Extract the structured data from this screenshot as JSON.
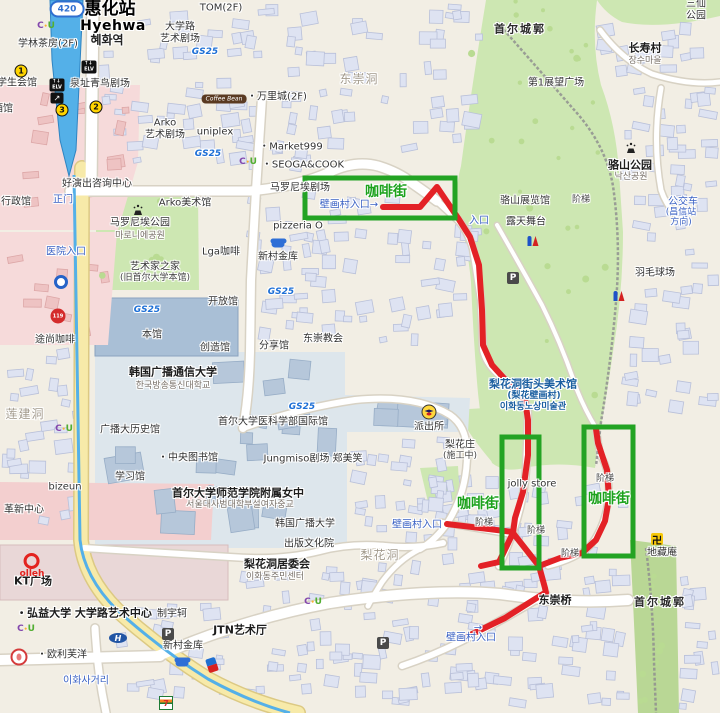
{
  "palette": {
    "route_red": "#e32126",
    "box_green": "#23a323",
    "coffee_green": "#1ca21c",
    "park_green": "#cde7b2",
    "water_blue": "#54b0e8",
    "road_yellow": "#f7eaa9"
  },
  "annotations": {
    "boxes": [
      {
        "x": 305,
        "y": 178,
        "w": 150,
        "h": 40
      },
      {
        "x": 502,
        "y": 437,
        "w": 37,
        "h": 131
      },
      {
        "x": 584,
        "y": 427,
        "w": 49,
        "h": 129
      }
    ],
    "routes": [
      [
        [
          383,
          207
        ],
        [
          420,
          207
        ],
        [
          437,
          187
        ],
        [
          458,
          218
        ],
        [
          470,
          237
        ],
        [
          479,
          265
        ],
        [
          482,
          310
        ],
        [
          483,
          345
        ],
        [
          492,
          365
        ],
        [
          512,
          387
        ],
        [
          525,
          400
        ],
        [
          528,
          420
        ],
        [
          528,
          455
        ],
        [
          523,
          492
        ],
        [
          515,
          518
        ],
        [
          513,
          533
        ]
      ],
      [
        [
          447,
          524
        ],
        [
          513,
          532
        ]
      ],
      [
        [
          513,
          533
        ],
        [
          499,
          562
        ],
        [
          481,
          566
        ]
      ],
      [
        [
          513,
          533
        ],
        [
          539,
          566
        ],
        [
          545,
          588
        ],
        [
          546,
          593
        ]
      ],
      [
        [
          543,
          594
        ],
        [
          505,
          618
        ],
        [
          462,
          639
        ]
      ],
      [
        [
          539,
          566
        ],
        [
          560,
          558
        ],
        [
          582,
          553
        ],
        [
          596,
          540
        ],
        [
          605,
          521
        ],
        [
          609,
          498
        ],
        [
          607,
          470
        ],
        [
          598,
          443
        ],
        [
          596,
          429
        ]
      ]
    ]
  },
  "labels": [
    {
      "t": "惠化站",
      "x": 110,
      "y": 10,
      "c": "st1"
    },
    {
      "t": "Hyehwa",
      "x": 113,
      "y": 26,
      "c": "st2"
    },
    {
      "t": "혜화역",
      "x": 107,
      "y": 41,
      "c": "st3"
    },
    {
      "t": "TOM(2F)",
      "x": 221,
      "y": 8,
      "c": "poi"
    },
    {
      "t": "学林茶房(2F)",
      "x": 48,
      "y": 44,
      "c": "poi"
    },
    {
      "t": "大学路\n艺术剧场",
      "x": 180,
      "y": 33,
      "c": "poi"
    },
    {
      "t": "学生会馆",
      "x": 17,
      "y": 83,
      "c": "poi"
    },
    {
      "t": "泉址青鸟剧场",
      "x": 100,
      "y": 84,
      "c": "poi"
    },
    {
      "t": "酒馆",
      "x": 3,
      "y": 109,
      "c": "poi"
    },
    {
      "t": "Arko\n艺术剧场",
      "x": 165,
      "y": 129,
      "c": "poi"
    },
    {
      "t": "uniplex",
      "x": 215,
      "y": 132,
      "c": "poi"
    },
    {
      "t": "・万里城(2F)",
      "x": 277,
      "y": 97,
      "c": "poi"
    },
    {
      "t": "东崇洞",
      "x": 359,
      "y": 80,
      "c": "area"
    },
    {
      "t": "・Market999",
      "x": 291,
      "y": 147,
      "c": "poi"
    },
    {
      "t": "・SEOGA&COOK",
      "x": 303,
      "y": 165,
      "c": "poi"
    },
    {
      "t": "三仙公园",
      "x": 696,
      "y": 10,
      "c": "poi"
    },
    {
      "t": "首尔城郭",
      "x": 520,
      "y": 30,
      "c": "wall"
    },
    {
      "t": "长寿村",
      "x": 645,
      "y": 49,
      "c": "lg"
    },
    {
      "t": "장수마을",
      "x": 645,
      "y": 61,
      "c": "kr"
    },
    {
      "t": "第1展望广场",
      "x": 556,
      "y": 83,
      "c": "poi"
    },
    {
      "t": "骆山公园",
      "x": 630,
      "y": 166,
      "c": "lg"
    },
    {
      "t": "낙산공원",
      "x": 631,
      "y": 177,
      "c": "kr"
    },
    {
      "t": "好演出咨询中心",
      "x": 97,
      "y": 184,
      "c": "poi"
    },
    {
      "t": "行政馆",
      "x": 16,
      "y": 202,
      "c": "poi"
    },
    {
      "t": "正门",
      "x": 63,
      "y": 200,
      "c": "blue"
    },
    {
      "t": "Arko美术馆",
      "x": 185,
      "y": 203,
      "c": "poi"
    },
    {
      "t": "马罗尼埃公园",
      "x": 140,
      "y": 223,
      "c": "poi"
    },
    {
      "t": "마로니에공원",
      "x": 140,
      "y": 236,
      "c": "kr"
    },
    {
      "t": "马罗尼埃剧场",
      "x": 300,
      "y": 188,
      "c": "poi"
    },
    {
      "t": "咖啡街",
      "x": 386,
      "y": 192,
      "c": "coffee"
    },
    {
      "t": "壁画村入口→",
      "x": 349,
      "y": 205,
      "c": "blue"
    },
    {
      "t": "pizzeria O",
      "x": 298,
      "y": 226,
      "c": "poi"
    },
    {
      "t": "医院入口",
      "x": 66,
      "y": 252,
      "c": "blue"
    },
    {
      "t": "艺术家之家",
      "x": 155,
      "y": 267,
      "c": "poi"
    },
    {
      "t": "(旧首尔大学本馆)",
      "x": 155,
      "y": 278,
      "c": "poi-s"
    },
    {
      "t": "Lga咖啡",
      "x": 221,
      "y": 252,
      "c": "poi"
    },
    {
      "t": "新村金库",
      "x": 278,
      "y": 257,
      "c": "poi"
    },
    {
      "t": "骆山展览馆",
      "x": 525,
      "y": 201,
      "c": "poi"
    },
    {
      "t": "阶梯",
      "x": 581,
      "y": 200,
      "c": "poi-s"
    },
    {
      "t": "露天舞台",
      "x": 526,
      "y": 222,
      "c": "poi"
    },
    {
      "t": "公交车站",
      "x": 683,
      "y": 208,
      "c": "blue"
    },
    {
      "t": "(昌信站方向)",
      "x": 681,
      "y": 218,
      "c": "blue-s"
    },
    {
      "t": "入口",
      "x": 479,
      "y": 221,
      "c": "blue"
    },
    {
      "t": "羽毛球场",
      "x": 655,
      "y": 273,
      "c": "poi"
    },
    {
      "t": "开放馆",
      "x": 223,
      "y": 302,
      "c": "poi"
    },
    {
      "t": "本馆",
      "x": 152,
      "y": 335,
      "c": "poi"
    },
    {
      "t": "东崇教会",
      "x": 323,
      "y": 339,
      "c": "poi"
    },
    {
      "t": "分享馆",
      "x": 274,
      "y": 346,
      "c": "poi"
    },
    {
      "t": "创造馆",
      "x": 215,
      "y": 348,
      "c": "poi"
    },
    {
      "t": "途尚咖啡",
      "x": 55,
      "y": 340,
      "c": "poi"
    },
    {
      "t": "莲建洞",
      "x": 25,
      "y": 415,
      "c": "area"
    },
    {
      "t": "韩国广播通信大学",
      "x": 173,
      "y": 373,
      "c": "lg"
    },
    {
      "t": "한국방송통신대학교",
      "x": 173,
      "y": 386,
      "c": "kr"
    },
    {
      "t": "广播大历史馆",
      "x": 130,
      "y": 430,
      "c": "poi"
    },
    {
      "t": "・中央图书馆",
      "x": 188,
      "y": 458,
      "c": "poi"
    },
    {
      "t": "学习馆",
      "x": 130,
      "y": 477,
      "c": "poi"
    },
    {
      "t": "bizeun",
      "x": 65,
      "y": 487,
      "c": "poi"
    },
    {
      "t": "革新中心",
      "x": 24,
      "y": 510,
      "c": "poi"
    },
    {
      "t": "首尔大学医科学部国际馆",
      "x": 273,
      "y": 422,
      "c": "poi"
    },
    {
      "t": "Jungmiso剧场 郑美笑",
      "x": 313,
      "y": 459,
      "c": "poi"
    },
    {
      "t": "派出所",
      "x": 429,
      "y": 427,
      "c": "poi"
    },
    {
      "t": "梨花庄",
      "x": 460,
      "y": 445,
      "c": "poi"
    },
    {
      "t": "(施工中)",
      "x": 460,
      "y": 456,
      "c": "poi-s"
    },
    {
      "t": "梨花洞街头美术馆",
      "x": 533,
      "y": 385,
      "c": "museum"
    },
    {
      "t": "(梨花壁画村)",
      "x": 534,
      "y": 396,
      "c": "museum-s"
    },
    {
      "t": "이화동노상미술관",
      "x": 533,
      "y": 407,
      "c": "museum-s"
    },
    {
      "t": "首尔大学师范学院附属女中",
      "x": 238,
      "y": 494,
      "c": "lg"
    },
    {
      "t": "서울대사범대학부설여자중교",
      "x": 240,
      "y": 505,
      "c": "kr"
    },
    {
      "t": "韩国广播大学",
      "x": 305,
      "y": 524,
      "c": "poi"
    },
    {
      "t": "出版文化院",
      "x": 309,
      "y": 544,
      "c": "poi"
    },
    {
      "t": "jolly store",
      "x": 532,
      "y": 484,
      "c": "poi"
    },
    {
      "t": "阶梯",
      "x": 484,
      "y": 523,
      "c": "poi-s"
    },
    {
      "t": "阶梯",
      "x": 536,
      "y": 531,
      "c": "poi-s"
    },
    {
      "t": "阶梯",
      "x": 570,
      "y": 554,
      "c": "poi-s"
    },
    {
      "t": "阶梯",
      "x": 605,
      "y": 479,
      "c": "poi-s"
    },
    {
      "t": "咖啡街",
      "x": 478,
      "y": 504,
      "c": "coffee"
    },
    {
      "t": "咖啡街",
      "x": 609,
      "y": 499,
      "c": "coffee"
    },
    {
      "t": "壁画村入口",
      "x": 417,
      "y": 525,
      "c": "blue"
    },
    {
      "t": "梨花洞",
      "x": 380,
      "y": 556,
      "c": "area"
    },
    {
      "t": "梨花洞居委会",
      "x": 277,
      "y": 565,
      "c": "lg"
    },
    {
      "t": "이화동주민센터",
      "x": 275,
      "y": 577,
      "c": "kr"
    },
    {
      "t": "东崇桥",
      "x": 555,
      "y": 601,
      "c": "lg"
    },
    {
      "t": "首尔城郭",
      "x": 660,
      "y": 603,
      "c": "wall"
    },
    {
      "t": "地藏庵",
      "x": 662,
      "y": 553,
      "c": "poi"
    },
    {
      "t": "→",
      "x": 478,
      "y": 628,
      "c": "blue"
    },
    {
      "t": "壁画村入口",
      "x": 471,
      "y": 638,
      "c": "blue"
    },
    {
      "t": "JTN艺术厅",
      "x": 240,
      "y": 631,
      "c": "lg"
    },
    {
      "t": "新村金库",
      "x": 183,
      "y": 646,
      "c": "poi"
    },
    {
      "t": "制宇轲",
      "x": 172,
      "y": 614,
      "c": "poi"
    },
    {
      "t": "・弘益大学 大学路艺术中心",
      "x": 84,
      "y": 614,
      "c": "lg"
    },
    {
      "t": "KT广场",
      "x": 33,
      "y": 582,
      "c": "lg"
    },
    {
      "t": "・欧利芙洋",
      "x": 62,
      "y": 655,
      "c": "poi"
    },
    {
      "t": "이화사거리",
      "x": 86,
      "y": 681,
      "c": "blue"
    },
    {
      "t": "GS25",
      "x": 205,
      "y": 52,
      "c": "gs"
    },
    {
      "t": "GS25",
      "x": 208,
      "y": 154,
      "c": "gs"
    },
    {
      "t": "GS25",
      "x": 147,
      "y": 310,
      "c": "gs"
    },
    {
      "t": "GS25",
      "x": 281,
      "y": 292,
      "c": "gs"
    },
    {
      "t": "GS25",
      "x": 302,
      "y": 407,
      "c": "gs"
    }
  ],
  "icons": [
    {
      "k": "route-badge",
      "x": 67,
      "y": 9,
      "t": "420"
    },
    {
      "k": "elv",
      "x": 89,
      "y": 67,
      "t": "↑↓\nELV"
    },
    {
      "k": "elv",
      "x": 57,
      "y": 85,
      "t": "↑↓\nELV"
    },
    {
      "k": "esc",
      "x": 57,
      "y": 98,
      "t": "↗"
    },
    {
      "k": "exit",
      "x": 21,
      "y": 71,
      "t": "1"
    },
    {
      "k": "exit",
      "x": 96,
      "y": 107,
      "t": "2"
    },
    {
      "k": "exit",
      "x": 62,
      "y": 110,
      "t": "3"
    },
    {
      "k": "subway",
      "x": 61,
      "y": 282
    },
    {
      "k": "fire",
      "x": 58,
      "y": 316,
      "t": "119"
    },
    {
      "k": "fountain",
      "x": 138,
      "y": 210
    },
    {
      "k": "fountain",
      "x": 631,
      "y": 148
    },
    {
      "k": "toilet",
      "x": 533,
      "y": 241
    },
    {
      "k": "toilet",
      "x": 619,
      "y": 296
    },
    {
      "k": "p",
      "x": 513,
      "y": 278,
      "t": "P"
    },
    {
      "k": "p",
      "x": 168,
      "y": 634,
      "t": "P"
    },
    {
      "k": "p",
      "x": 383,
      "y": 643,
      "t": "P"
    },
    {
      "k": "police",
      "x": 429,
      "y": 412
    },
    {
      "k": "cloud",
      "x": 278,
      "y": 244
    },
    {
      "k": "cloud",
      "x": 182,
      "y": 663
    },
    {
      "k": "cu",
      "x": 46,
      "y": 26,
      "t": "C•U"
    },
    {
      "k": "cu",
      "x": 248,
      "y": 162,
      "t": "C•U"
    },
    {
      "k": "cu",
      "x": 64,
      "y": 429,
      "t": "C•U"
    },
    {
      "k": "cu",
      "x": 26,
      "y": 629,
      "t": "C•U"
    },
    {
      "k": "cu",
      "x": 313,
      "y": 602,
      "t": "C•U"
    },
    {
      "k": "coffeebean",
      "x": 224,
      "y": 99,
      "t": "Coffee Bean"
    },
    {
      "k": "olleh",
      "x": 32,
      "y": 566,
      "t": "olleh"
    },
    {
      "k": "hyundai",
      "x": 118,
      "y": 638,
      "t": "H"
    },
    {
      "k": "dominos",
      "x": 212,
      "y": 665
    },
    {
      "k": "seven",
      "x": 166,
      "y": 703,
      "t": "7"
    },
    {
      "k": "oliveyoung",
      "x": 19,
      "y": 657
    },
    {
      "k": "swastika",
      "x": 657,
      "y": 539,
      "t": "卍"
    }
  ]
}
